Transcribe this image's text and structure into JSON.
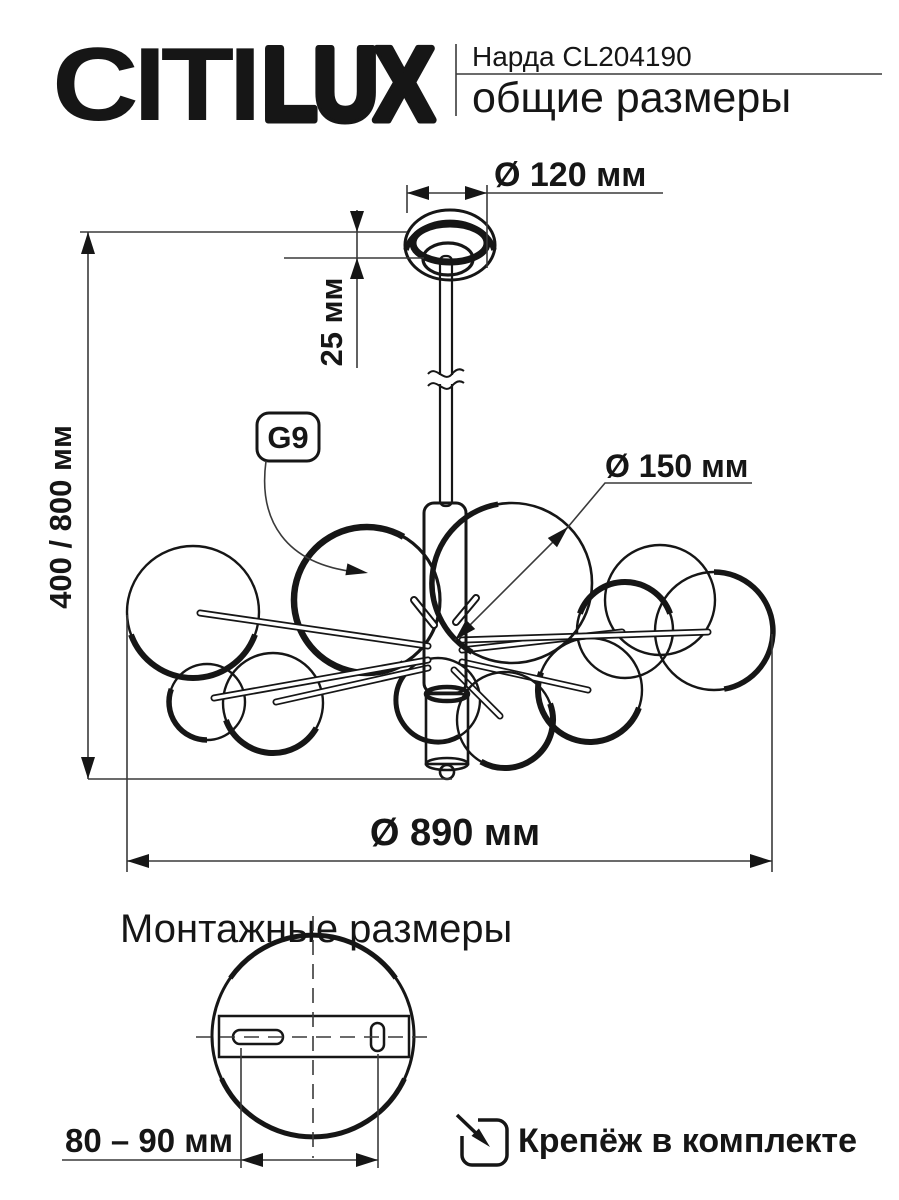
{
  "page": {
    "background": "#ffffff",
    "ink_color": "#161616"
  },
  "header": {
    "logo_citi": "CITI",
    "logo_lux": "LUX",
    "model": "Нарда CL204190",
    "subtitle": "общие размеры"
  },
  "overall_dimensions": {
    "canopy_diameter_label": "Ø 120 мм",
    "canopy_drop_label": "25 мм",
    "height_range_label": "400 / 800 мм",
    "lamp_socket_label": "G9",
    "globe_diameter_label": "Ø 150 мм",
    "overall_diameter_label": "Ø 890 мм"
  },
  "mounting": {
    "section_title": "Монтажные размеры",
    "hole_spacing_label": "80 – 90 мм",
    "hardware_note": "Крепёж в комплекте"
  }
}
